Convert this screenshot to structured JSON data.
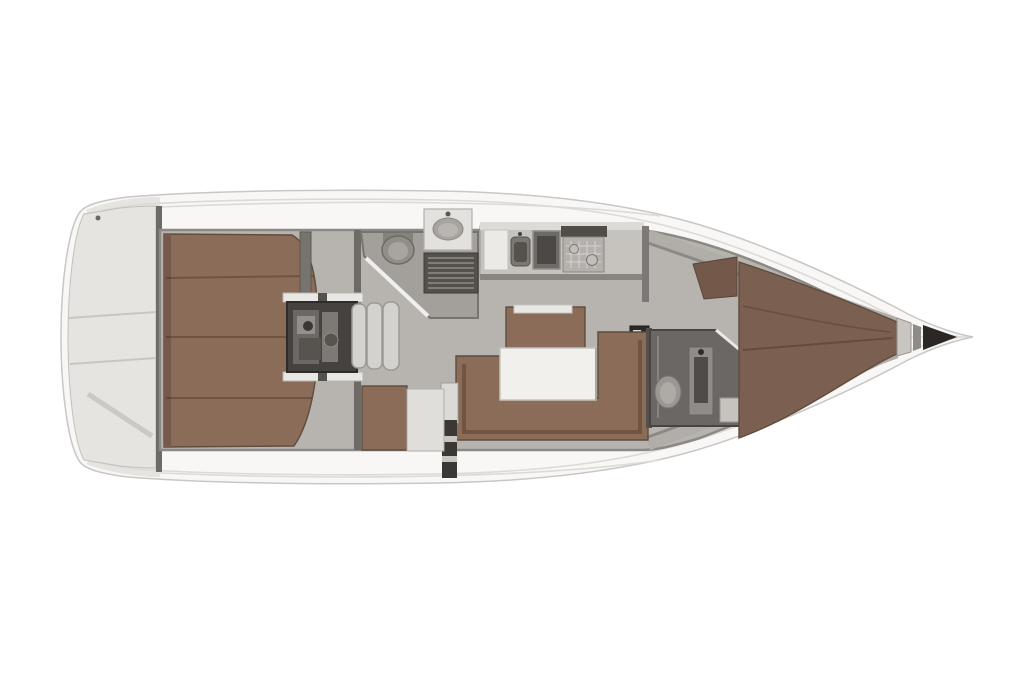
{
  "figure": {
    "kind": "yacht-interior-floor-plan",
    "orientation": "bow-right",
    "areas": [
      "stern-platform",
      "aft-cabin-berth",
      "engine-compartment",
      "companionway-steps",
      "aft-head",
      "toilet",
      "washbasin",
      "louver-locker",
      "galley",
      "galley-sinks",
      "stove",
      "salon-settee",
      "salon-table",
      "port-bench",
      "nav-seat",
      "nav-table",
      "forward-head",
      "shower",
      "forward-cabin-berth",
      "wardrobe",
      "anchor-locker"
    ]
  },
  "palette": {
    "background": "#ffffff",
    "hull_fill": "#f8f7f5",
    "hull_stroke": "#c9c7c4",
    "deck_seam": "#dcdad7",
    "deck_shade": "#dddbd7",
    "floor": "#b7b4b0",
    "floor_dark": "#a3a09c",
    "wall": "#6e6b67",
    "wall_light": "#8d8a86",
    "wood": "#8b6c58",
    "wood_dark": "#7b6051",
    "wood_edge": "#5e4c3d",
    "table": "#f2f0ec",
    "fixture": "#e3e1de",
    "metal": "#918e8a",
    "dark": "#45423f",
    "darker": "#2b2725",
    "steps": "#d4d2cf"
  }
}
